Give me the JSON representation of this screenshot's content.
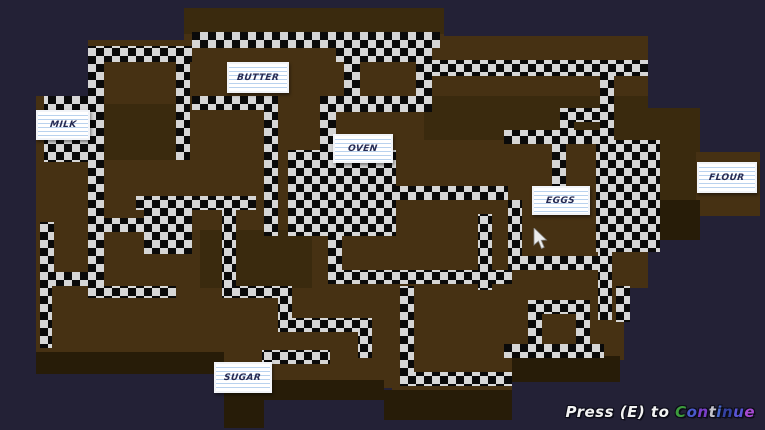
{
  "window": {
    "width": 765,
    "height": 430,
    "kind": "game-level-map"
  },
  "palette": {
    "background": "#232136",
    "brown_base": "#463113",
    "brown_dark": "#3a2a0e",
    "brown_darker": "#271c08",
    "checker_light": "#d6d6d6",
    "checker_dark": "#0a0a0a",
    "sign_background": "#ffffff",
    "sign_line": "#b9d2ee",
    "sign_text": "#262a52",
    "footer_text": "#f2f2f2"
  },
  "labels": [
    {
      "id": "milk",
      "text": "MILK",
      "x": 36,
      "y": 110,
      "w": 54,
      "h": 30
    },
    {
      "id": "butter",
      "text": "BUTTER",
      "x": 227,
      "y": 62,
      "w": 62,
      "h": 31
    },
    {
      "id": "oven",
      "text": "OVEN",
      "x": 333,
      "y": 134,
      "w": 60,
      "h": 29
    },
    {
      "id": "eggs",
      "text": "EGGS",
      "x": 532,
      "y": 186,
      "w": 58,
      "h": 29
    },
    {
      "id": "flour",
      "text": "FLOUR",
      "x": 697,
      "y": 162,
      "w": 60,
      "h": 31
    },
    {
      "id": "sugar",
      "text": "SUGAR",
      "x": 214,
      "y": 362,
      "w": 58,
      "h": 31
    }
  ],
  "footer": {
    "prefix": "Press (E) to ",
    "word": "Continue",
    "letter_colors": [
      [
        "C",
        "#3d9c3d"
      ],
      [
        "o",
        "#4a5acc"
      ],
      [
        "n",
        "#7a3fc9"
      ],
      [
        "t",
        "#c4c4cc"
      ],
      [
        "i",
        "#4a6ad0"
      ],
      [
        "n",
        "#3542a3"
      ],
      [
        "u",
        "#5a55d6"
      ],
      [
        "e",
        "#a84ad2"
      ]
    ]
  },
  "cursor": {
    "x": 533,
    "y": 228
  },
  "maze": {
    "blocks": [
      [
        184,
        8,
        260,
        56,
        1
      ],
      [
        88,
        40,
        100,
        124,
        1
      ],
      [
        36,
        96,
        60,
        72,
        1
      ],
      [
        64,
        112,
        32,
        56,
        2
      ],
      [
        36,
        160,
        152,
        130,
        1
      ],
      [
        184,
        48,
        262,
        240,
        1
      ],
      [
        444,
        36,
        204,
        252,
        1
      ],
      [
        648,
        108,
        52,
        132,
        2
      ],
      [
        696,
        152,
        64,
        64,
        1
      ],
      [
        36,
        288,
        188,
        76,
        1
      ],
      [
        224,
        288,
        168,
        100,
        1
      ],
      [
        392,
        288,
        120,
        104,
        1
      ],
      [
        512,
        288,
        112,
        72,
        1
      ],
      [
        184,
        8,
        260,
        26,
        2
      ],
      [
        88,
        104,
        100,
        56,
        2
      ],
      [
        424,
        96,
        224,
        44,
        2
      ],
      [
        200,
        230,
        112,
        58,
        2
      ],
      [
        648,
        200,
        52,
        40,
        3
      ],
      [
        36,
        352,
        188,
        22,
        3
      ],
      [
        224,
        380,
        160,
        20,
        3
      ],
      [
        384,
        390,
        128,
        30,
        3
      ],
      [
        512,
        356,
        108,
        26,
        3
      ],
      [
        224,
        396,
        40,
        32,
        3
      ]
    ],
    "rooms": [
      [
        288,
        150,
        108,
        86
      ],
      [
        596,
        140,
        64,
        112
      ]
    ],
    "paths": [
      [
        192,
        32,
        248,
        16
      ],
      [
        336,
        48,
        96,
        14
      ],
      [
        344,
        62,
        16,
        36
      ],
      [
        416,
        62,
        16,
        40
      ],
      [
        320,
        96,
        112,
        16
      ],
      [
        320,
        112,
        16,
        40
      ],
      [
        432,
        60,
        216,
        16
      ],
      [
        600,
        76,
        14,
        56
      ],
      [
        504,
        130,
        110,
        14
      ],
      [
        560,
        108,
        14,
        34
      ],
      [
        560,
        108,
        54,
        14
      ],
      [
        552,
        144,
        14,
        44
      ],
      [
        96,
        46,
        96,
        16
      ],
      [
        88,
        46,
        16,
        240
      ],
      [
        176,
        46,
        14,
        114
      ],
      [
        44,
        96,
        52,
        66
      ],
      [
        192,
        96,
        80,
        14
      ],
      [
        264,
        96,
        14,
        140
      ],
      [
        136,
        196,
        120,
        14
      ],
      [
        222,
        196,
        14,
        92
      ],
      [
        88,
        218,
        60,
        14
      ],
      [
        144,
        196,
        48,
        58
      ],
      [
        40,
        222,
        14,
        64
      ],
      [
        40,
        272,
        62,
        14
      ],
      [
        328,
        236,
        14,
        48
      ],
      [
        328,
        270,
        184,
        14
      ],
      [
        396,
        186,
        112,
        14
      ],
      [
        478,
        214,
        14,
        76
      ],
      [
        508,
        200,
        14,
        70
      ],
      [
        508,
        256,
        104,
        14
      ],
      [
        598,
        214,
        14,
        106
      ],
      [
        40,
        286,
        12,
        62
      ],
      [
        88,
        286,
        88,
        12
      ],
      [
        222,
        286,
        70,
        12
      ],
      [
        278,
        286,
        14,
        46
      ],
      [
        278,
        318,
        80,
        14
      ],
      [
        358,
        318,
        14,
        40
      ],
      [
        262,
        350,
        68,
        14
      ],
      [
        400,
        286,
        14,
        100
      ],
      [
        400,
        372,
        112,
        14
      ],
      [
        504,
        344,
        100,
        14
      ],
      [
        528,
        300,
        14,
        44
      ],
      [
        576,
        300,
        14,
        44
      ],
      [
        528,
        300,
        62,
        14
      ],
      [
        616,
        286,
        14,
        36
      ]
    ]
  }
}
